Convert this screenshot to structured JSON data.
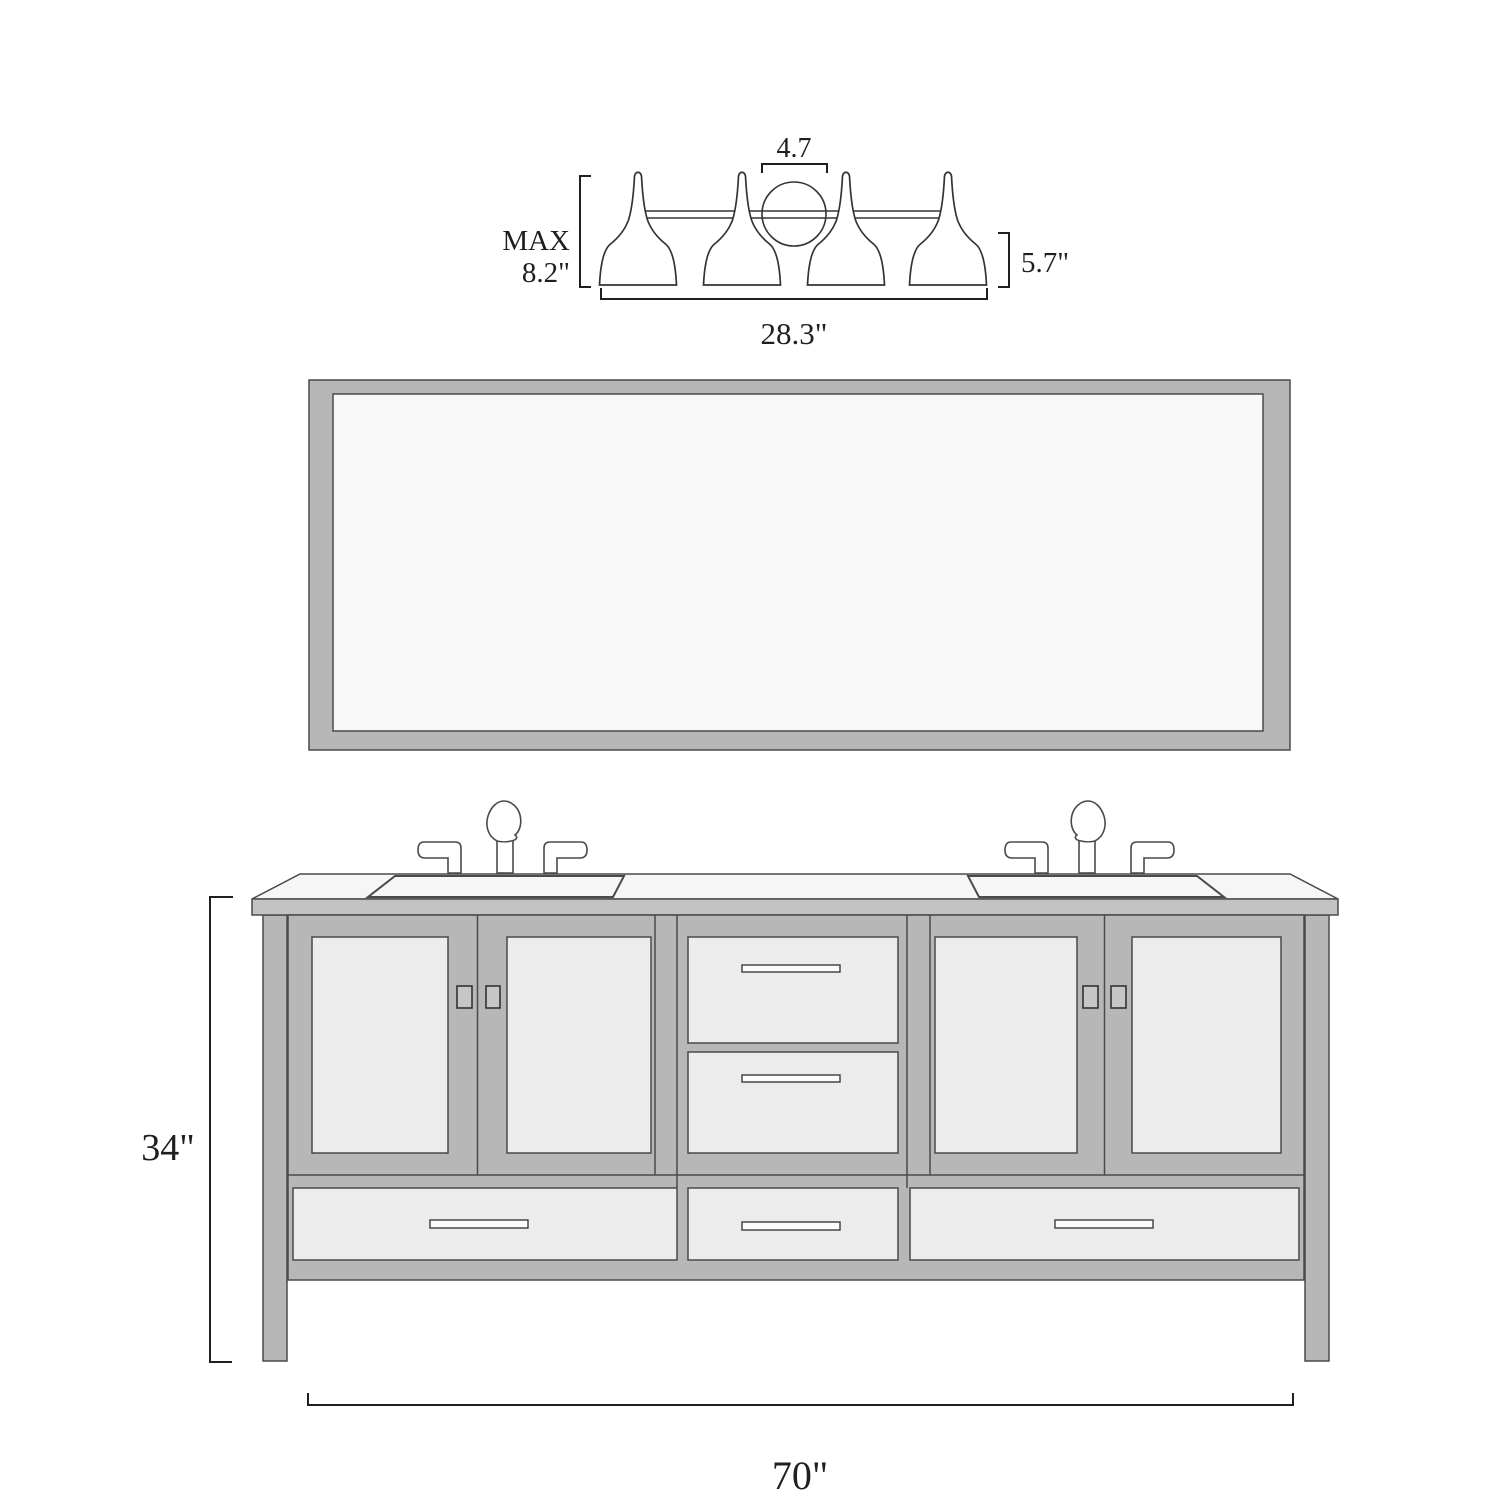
{
  "title": "Bathroom vanity set dimension diagram",
  "colors": {
    "background": "#ffffff",
    "frame_gray": "#b7b7b7",
    "panel_light": "#ececec",
    "counter_band": "#c3c3c3",
    "surface_white": "#f6f6f6",
    "mirror_glass": "#f8f8f8",
    "outline": "#4a4a4a",
    "fixture_stroke": "#333333",
    "dim_line": "#1f1f1f"
  },
  "light_fixture": {
    "shade_count": 4,
    "dim_top_width": "4.7",
    "dim_max_height": [
      "MAX",
      "8.2\""
    ],
    "dim_shade_height": "5.7\"",
    "dim_total_width": "28.3\""
  },
  "mirror": {
    "present": true
  },
  "vanity": {
    "sink_count": 2,
    "faucet_count": 2,
    "door_count": 4,
    "center_drawer_count": 2,
    "bottom_drawer_count": 3,
    "dim_height": "34\"",
    "dim_width": "70\""
  }
}
